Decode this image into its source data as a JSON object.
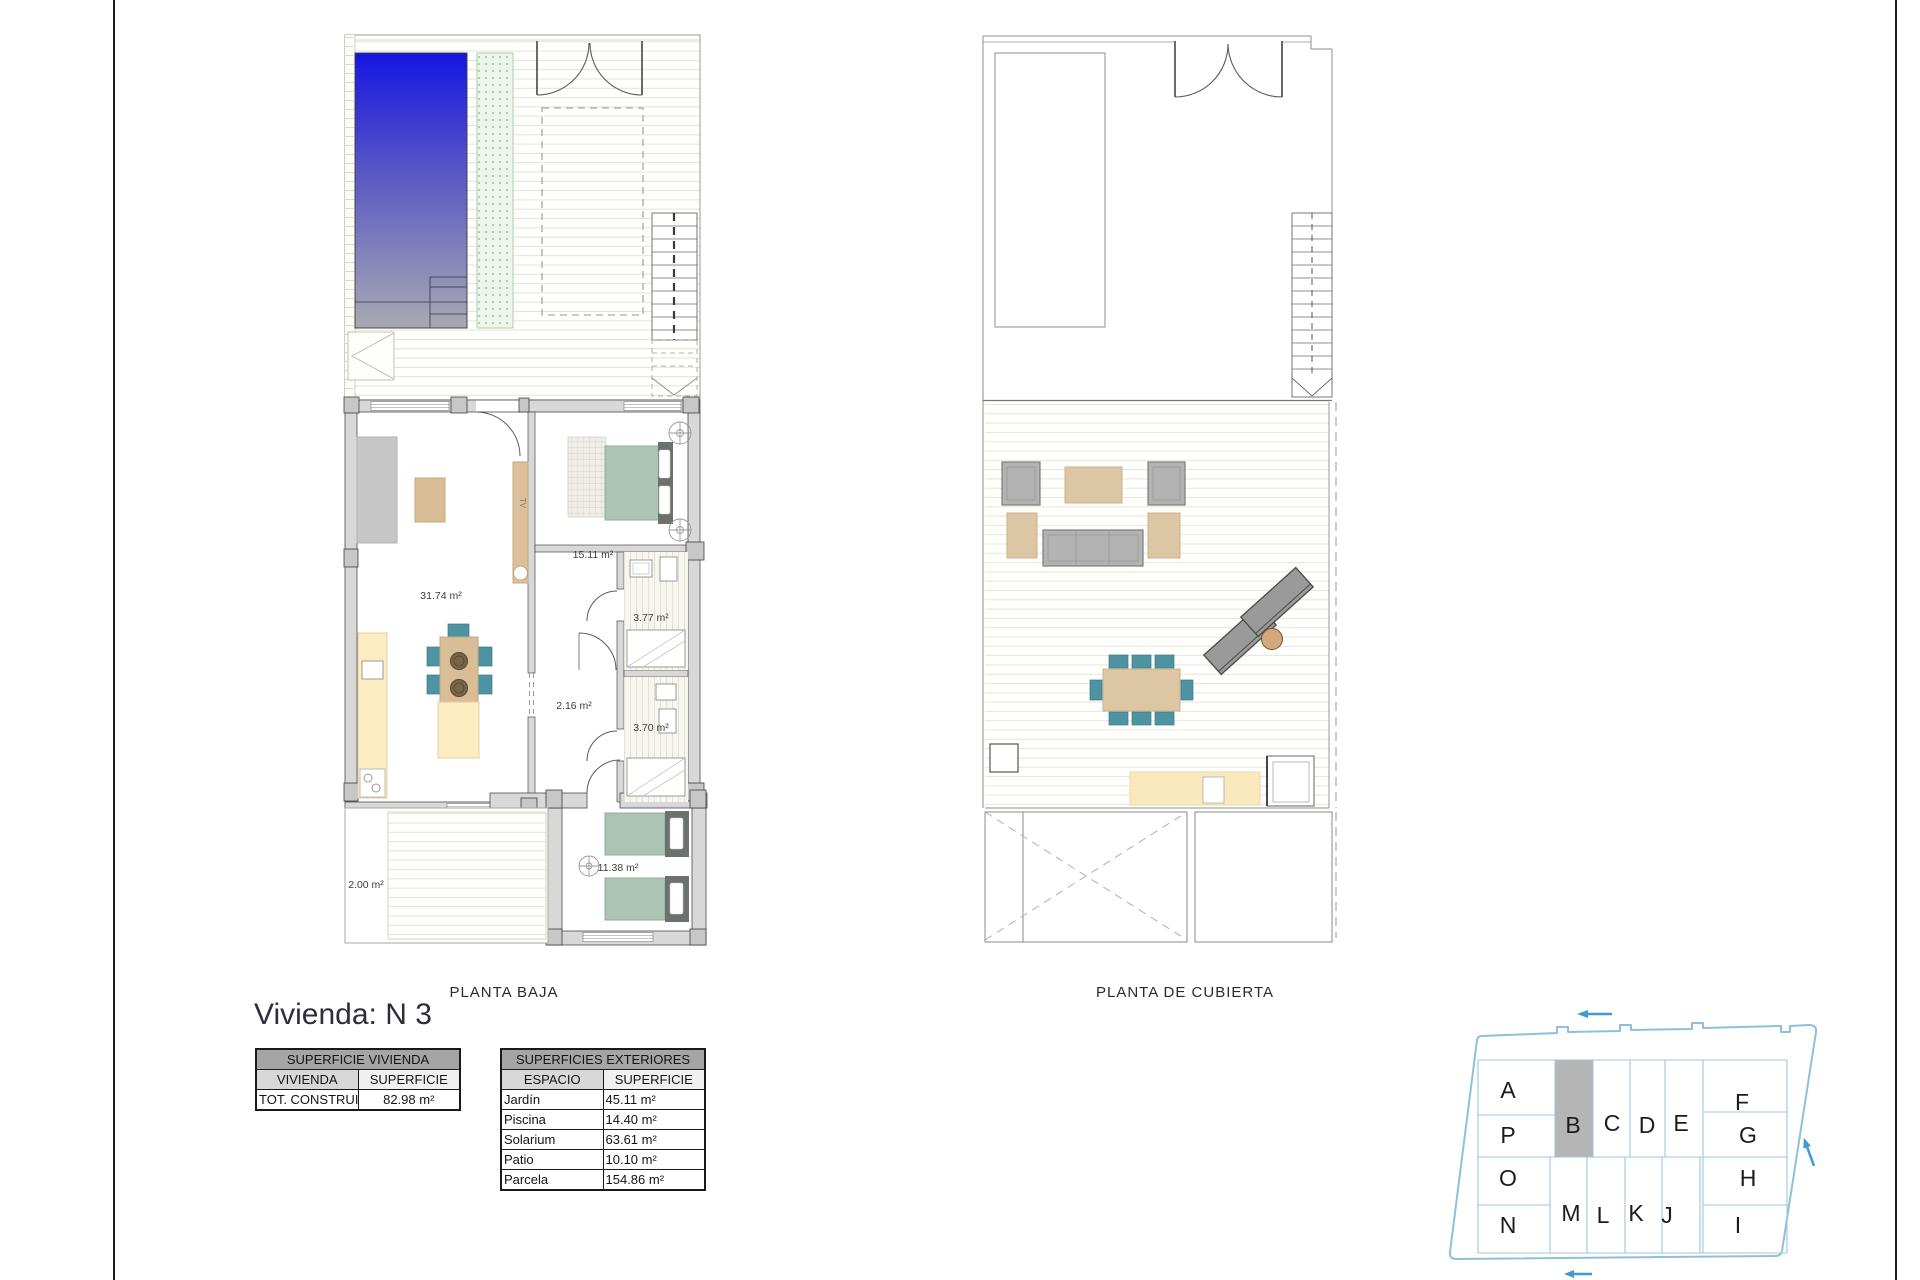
{
  "title": "Vivienda: N 3",
  "plans": {
    "planta_baja": {
      "label": "PLANTA BAJA",
      "tv_label": "TV",
      "areas": {
        "living": "31.74 m²",
        "bedroom1": "15.11 m²",
        "bath1": "3.77 m²",
        "hall": "2.16 m²",
        "bath2": "3.70 m²",
        "bedroom2": "11.38 m²",
        "patio": "2.00 m²"
      }
    },
    "planta_cubierta": {
      "label": "PLANTA DE CUBIERTA"
    }
  },
  "tables": {
    "vivienda": {
      "title": "SUPERFICIE VIVIENDA",
      "columns": [
        "VIVIENDA",
        "SUPERFICIE"
      ],
      "rows": [
        [
          "TOT. CONSTRUIDA",
          "82.98 m²"
        ]
      ]
    },
    "exteriores": {
      "title": "SUPERFICIES EXTERIORES",
      "columns": [
        "ESPACIO",
        "SUPERFICIE"
      ],
      "rows": [
        [
          "Jardín",
          "45.11 m²"
        ],
        [
          "Piscina",
          "14.40 m²"
        ],
        [
          "Solarium",
          "63.61 m²"
        ],
        [
          "Patio",
          "10.10 m²"
        ],
        [
          "Parcela",
          "154.86 m²"
        ]
      ]
    }
  },
  "siteplan": {
    "highlighted_unit": "B",
    "units": [
      "A",
      "B",
      "C",
      "D",
      "E",
      "F",
      "G",
      "H",
      "I",
      "J",
      "K",
      "L",
      "M",
      "N",
      "O",
      "P"
    ]
  },
  "colors": {
    "pool_blue_top": "#1515e2",
    "pool_gray_bottom": "#a9a9b2",
    "bed_green": "#abc4b4",
    "chair_teal": "#4d93a2",
    "counter_yellow": "#fbecc2",
    "wood_beige": "#d9bd97",
    "wall_gray": "#d8d8d8",
    "siteplan_blue": "#8fc0da",
    "arrow_blue": "#3f9ad2",
    "highlight_gray": "#b5b5b5",
    "table_header_gray": "#a5a5a5"
  }
}
